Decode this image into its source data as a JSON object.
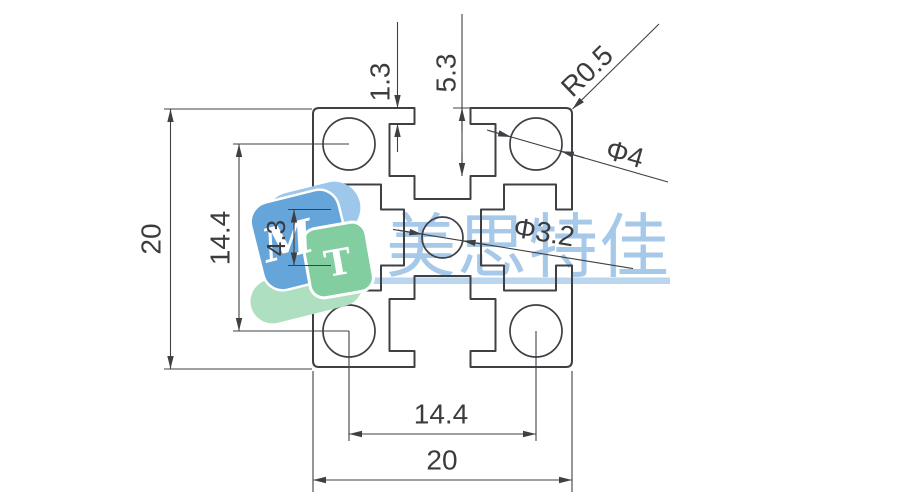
{
  "page": {
    "background": "#ffffff",
    "width": 900,
    "height": 500
  },
  "dimensions": {
    "overall_height": "20",
    "hole_pitch_vertical": "14.4",
    "slot_opening": "4.3",
    "lip_thickness": "1.3",
    "slot_depth": "5.3",
    "corner_radius": "R0.5",
    "corner_hole_diameter": "Φ4",
    "center_hole_diameter": "Φ3.2",
    "hole_pitch_horizontal": "14.4",
    "overall_width": "20"
  },
  "watermark": {
    "brand_text": "美思特佳",
    "logo_letter_m": "M",
    "logo_letter_t": "T"
  },
  "colors": {
    "line": "#3F4043",
    "dimension_text": "#3B3C3E",
    "watermark_text": "#A6C8E9",
    "watermark_underline": "#BAD5EE",
    "logo_blue": "#66A5DA",
    "logo_blue_light": "#9DC7EB",
    "logo_green": "#82CEA0",
    "logo_green_light": "#AEDFC0"
  }
}
